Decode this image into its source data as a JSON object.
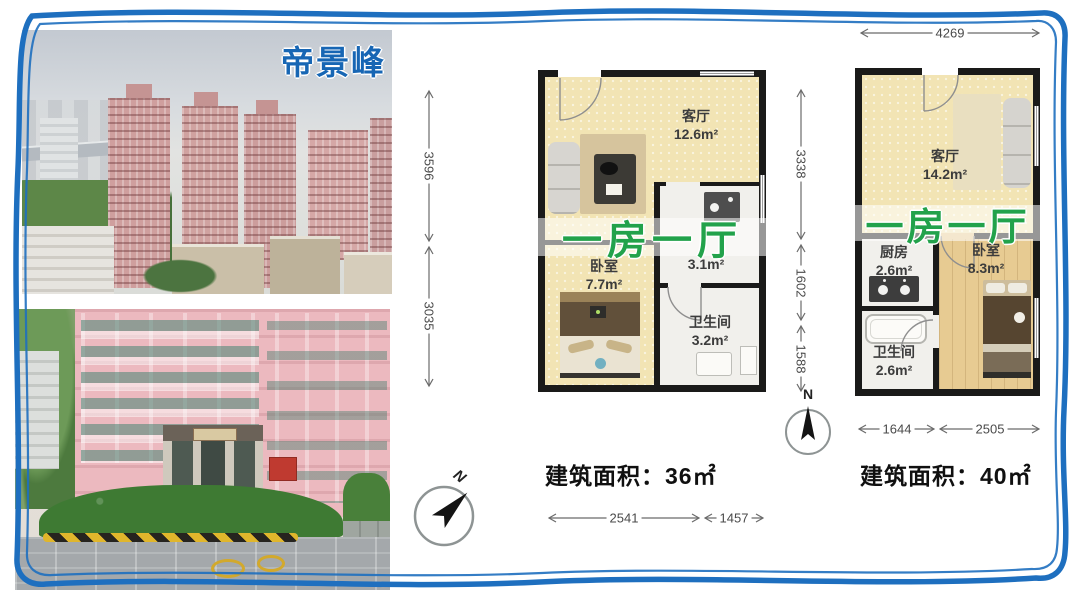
{
  "project": {
    "title": "帝景峰"
  },
  "plan36": {
    "overlay": "一房一厅",
    "building_area": "建筑面积：36㎡",
    "rooms": {
      "living": {
        "name": "客厅",
        "area": "12.6m²"
      },
      "bedroom": {
        "name": "卧室",
        "area": "7.7m²"
      },
      "kitchen": {
        "name": "",
        "area": "3.1m²"
      },
      "bath": {
        "name": "卫生间",
        "area": "3.2m²"
      }
    },
    "dims": {
      "left_upper": "3596",
      "left_lower": "3035",
      "bottom_left": "2541",
      "bottom_right": "1457"
    },
    "compass": "N"
  },
  "plan40": {
    "overlay": "一房一厅",
    "building_area": "建筑面积：40㎡",
    "rooms": {
      "living": {
        "name": "客厅",
        "area": "14.2m²"
      },
      "kitchen": {
        "name": "厨房",
        "area": "2.6m²"
      },
      "bath": {
        "name": "卫生间",
        "area": "2.6m²"
      },
      "bedroom": {
        "name": "卧室",
        "area": "8.3m²"
      }
    },
    "dims": {
      "top": "4269",
      "left_upper": "3338",
      "left_middle": "1602",
      "left_lower": "1588",
      "bottom_left": "1644",
      "bottom_right": "2505"
    },
    "compass": "N"
  },
  "colors": {
    "border_blue": "#1e6fbf",
    "title_blue": "#1766b4",
    "overlay_green": "#22a24b",
    "floor_cream": "#f2e4b4"
  }
}
